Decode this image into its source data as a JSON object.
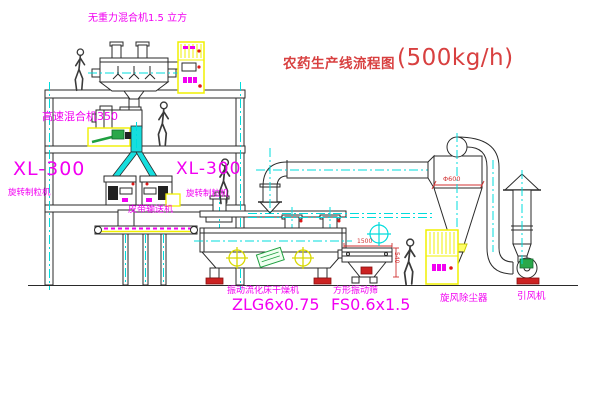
{
  "colors": {
    "magenta": "#f200f2",
    "red": "#d84040",
    "dark-red": "#cc2020",
    "cyan": "#00dcdc",
    "yellow": "#f0f000",
    "green": "#1fa040",
    "line": "#2a2a2a"
  },
  "title": {
    "text": "农药生产线流程图",
    "capacity": "(500kg/h)"
  },
  "labels": {
    "gravity_mixer": "无重力混合机1.5 立方",
    "high_speed_mixer": "高速混合机350",
    "granulator_model_left": "XL-300",
    "granulator_name_left": "旋转制粒机",
    "granulator_model_right": "XL-300",
    "granulator_name_right": "旋转制粒机",
    "belt_conveyor": "皮带输送机",
    "dryer": "振动流化床干燥机",
    "dryer_model": "ZLG6x0.75",
    "sieve": "方形振动筛",
    "sieve_model": "FS0.6x1.5",
    "cyclone": "旋风除尘器",
    "fan": "引风机"
  },
  "dimensions": {
    "cyclone_dia": "Φ600",
    "sieve_length": "1500",
    "sieve_height": "540"
  }
}
